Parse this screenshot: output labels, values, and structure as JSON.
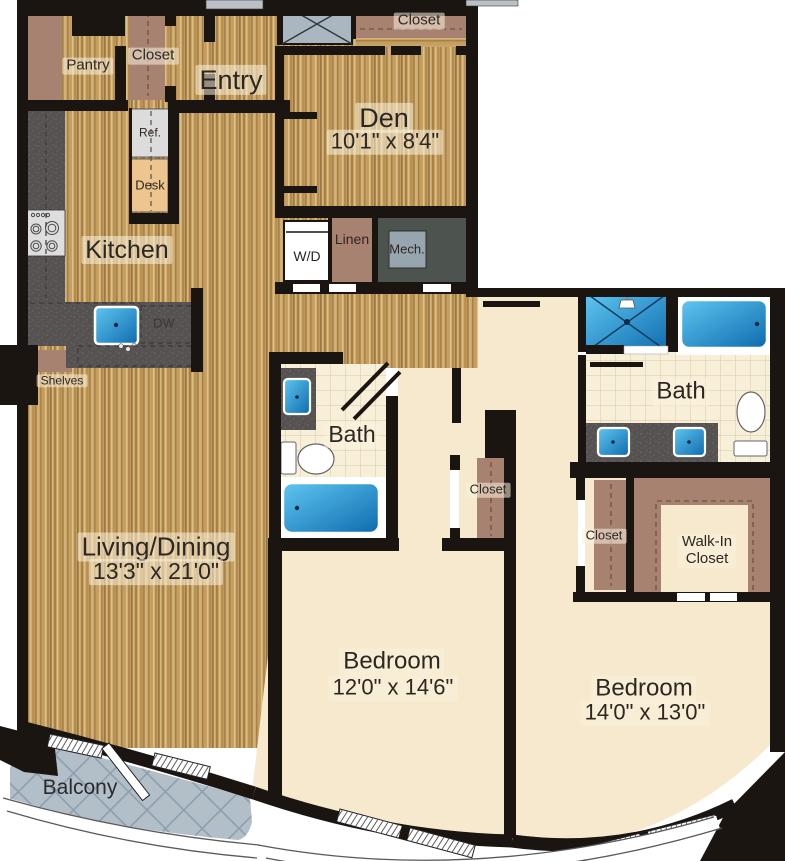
{
  "labels": {
    "pantry": "Pantry",
    "entry_closet": "Closet",
    "entry": "Entry",
    "den_closet": "Closet",
    "den": "Den",
    "den_dim": "10'1\" x 8'4\"",
    "ref": "Ref.",
    "desk": "Desk",
    "kitchen": "Kitchen",
    "wd": "W/D",
    "linen": "Linen",
    "mech": "Mech.",
    "dw": "DW",
    "shelves": "Shelves",
    "bath_1": "Bath",
    "bedroom_1_closet": "Closet",
    "living_dining": "Living/Dining",
    "living_dining_dim": "13'3\" x 21'0\"",
    "bath_2": "Bath",
    "bedroom_2_closet": "Closet",
    "walk_in_line1": "Walk-In",
    "walk_in_line2": "Closet",
    "bedroom_1": "Bedroom",
    "bedroom_1_dim": "12'0\" x 14'6\"",
    "bedroom_2": "Bedroom",
    "bedroom_2_dim": "14'0\" x 13'0\"",
    "balcony": "Balcony"
  },
  "colors": {
    "wall": "#1b1511",
    "wood_floor": "#c8a467",
    "bedroom_cream": "#f7e9cd",
    "tile": "#f8efd8",
    "closet_brown": "#a88271",
    "counter_gray": "#565252",
    "fixture_blue": "#1f87c9",
    "balcony_gray": "#b2bfc9",
    "shaft_gray": "#aab7c1"
  },
  "fixtures": [
    "stove-icon",
    "refrigerator-icon",
    "desk-icon",
    "kitchen-sink-icon",
    "dishwasher-outline",
    "washer-dryer-icon",
    "linen-shelf",
    "mech-unit",
    "shaft-x-icon",
    "bath-sink-icon",
    "toilet-icon",
    "bathtub-icon",
    "shower-icon",
    "double-vanity",
    "balcony-door-icon",
    "window-icon"
  ]
}
